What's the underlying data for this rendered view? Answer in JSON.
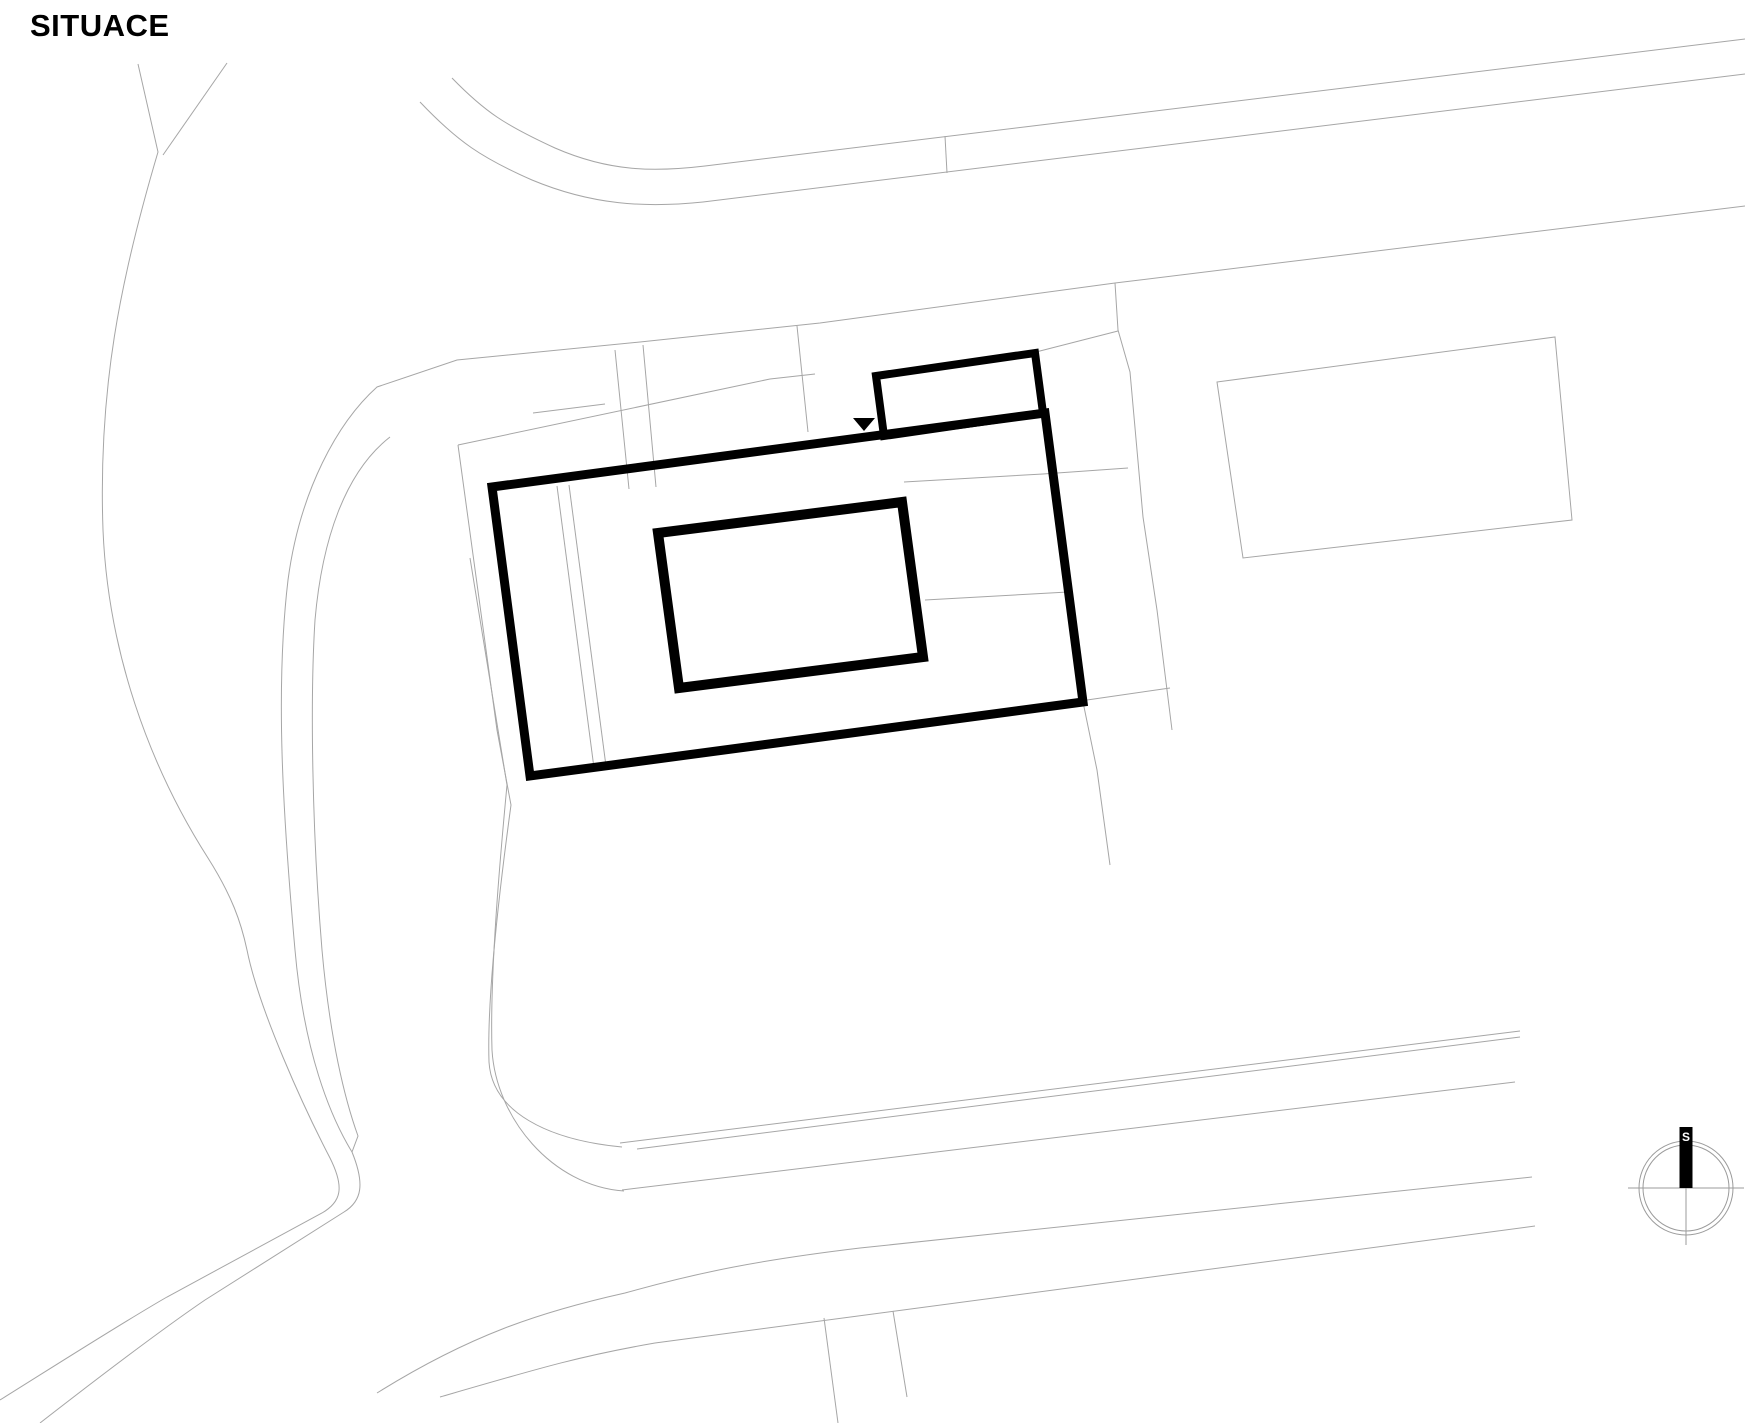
{
  "title": "SITUACE",
  "compass": {
    "north_label": "S",
    "description": "north-arrow"
  },
  "colors": {
    "background": "#ffffff",
    "building_outline": "#000000",
    "parcel_lines": "#a6a6a6"
  },
  "drawing": {
    "type": "architectural-site-plan",
    "building_label": "building-footprint",
    "entrance_marker": "triangle-down"
  }
}
